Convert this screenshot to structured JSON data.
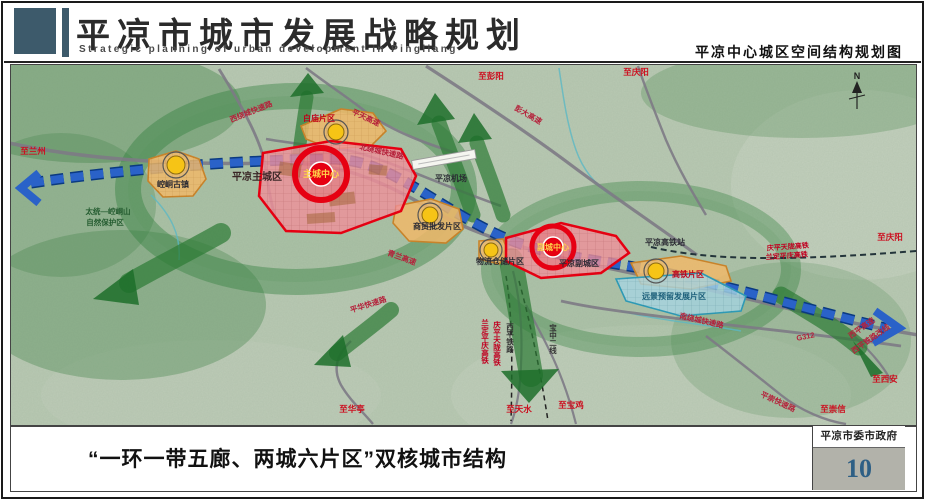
{
  "header": {
    "title": "平凉市城市发展战略规划",
    "subtitle_en": "Strategic planning of urban development in Pingliang",
    "map_title": "平凉中心城区空间结构规划图"
  },
  "map": {
    "zones": {
      "kongtong": "崆峒古镇",
      "baimiao": "白庙片区",
      "main_city": "平凉主城区",
      "main_core": "主城中心",
      "trade": "商贸批发片区",
      "logistics": "物流仓储片区",
      "sub_city": "平凉副城区",
      "sub_core": "副城中心",
      "hsr": "高铁片区",
      "reserve": "远景预留发展片区"
    },
    "features": {
      "airport": "平凉机场",
      "hsr_station": "平凉高铁站",
      "nature_line1": "太统—崆峒山",
      "nature_line2": "自然保护区",
      "compass_n": "N"
    },
    "roads": {
      "west_ring": "西绕城快速路",
      "north_ring": "北绕城快速路",
      "south_ring": "南绕城快速路",
      "pingtian": "平天高速",
      "pengda": "彭大高速",
      "qinglan": "青兰高速",
      "pinghua": "平华快速路",
      "pingchong": "平崇快速路",
      "g312": "G312",
      "xiping_expwy": "西平高速",
      "xiping_rail": "西平铁路改线"
    },
    "rails": {
      "qingpingtianlong": "庆平天陇高铁",
      "landingpingqing": "兰定平庆高铁",
      "xiping": "西平铁路",
      "baozhong": "宝中二线"
    },
    "destinations": {
      "lanzhou": "至兰州",
      "pengyang": "至彭阳",
      "qingyang": "至庆阳",
      "huating": "至华亭",
      "tianshui": "至天水",
      "baoji": "至宝鸡",
      "xian": "至西安",
      "chongxin": "至崇信"
    }
  },
  "caption": "“一环一带五廊、两城六片区”双核城市结构",
  "footer": {
    "org": "平凉市委市政府",
    "page": "10"
  },
  "colors": {
    "core_red": "#e60012",
    "axis_blue": "#2a62c8",
    "zone_orange": "#f0b05a",
    "zone_red": "#f0909a",
    "zone_blue": "#a6d4e2",
    "eco_green": "#2c7a35",
    "header_navy": "#3d5a6b",
    "page_num_blue": "#2e5f85"
  }
}
